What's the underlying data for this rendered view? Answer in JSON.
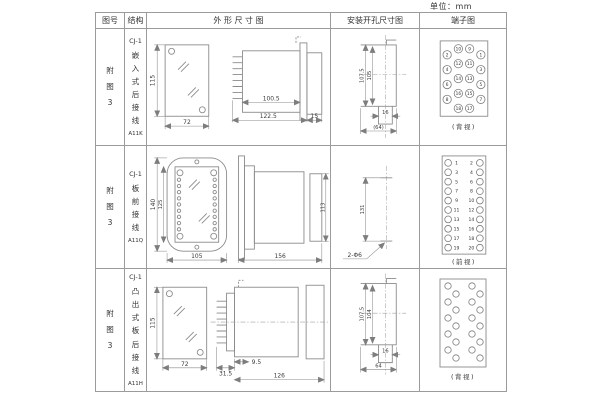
{
  "unit_label": "单位：mm",
  "table": {
    "columns": [
      "图号",
      "结构",
      "外 形 尺 寸 图",
      "安装开孔尺寸图",
      "端子图"
    ]
  },
  "rows": [
    {
      "figure_no": "附图3",
      "structure": {
        "model": "CJ-1",
        "desc": "嵌入式后接线",
        "code": "A11K"
      },
      "outline": {
        "front_height": "115",
        "front_width": "72",
        "body_length": "100.5",
        "total_length": "122.5",
        "rear_depth": "15"
      },
      "mounting": {
        "height_outer": "107.5",
        "height_inner": "105",
        "slot_width": "16",
        "cutout_width": "(64)"
      },
      "terminal": {
        "caption": "(背视)",
        "col_left": [
          "2",
          "4",
          "6",
          "8"
        ],
        "col_mid_left": [
          "10",
          "12",
          "14",
          "16",
          "18"
        ],
        "col_mid_right": [
          "9",
          "11",
          "13",
          "15",
          "17"
        ],
        "col_right": [
          "1",
          "3",
          "5",
          "7"
        ]
      }
    },
    {
      "figure_no": "附图3",
      "structure": {
        "model": "CJ-1",
        "desc": "板前接线",
        "code": "A11Q"
      },
      "outline": {
        "front_outer_height": "140",
        "front_inner_height": "125",
        "front_width": "105",
        "side_length": "156",
        "side_height": "113"
      },
      "mounting": {
        "hole_spacing": "131",
        "hole_label": "2-Φ6"
      },
      "terminal": {
        "caption": "(前视)",
        "col_left": [
          "1",
          "3",
          "5",
          "7",
          "9",
          "11",
          "13",
          "15",
          "17",
          "19"
        ],
        "col_right": [
          "2",
          "4",
          "6",
          "8",
          "10",
          "12",
          "14",
          "16",
          "18",
          "20"
        ]
      }
    },
    {
      "figure_no": "附图3",
      "structure": {
        "model": "CJ-1",
        "desc": "凸出式板后接线",
        "code": "A11H"
      },
      "outline": {
        "front_height": "115",
        "front_width": "72",
        "front_depth": "31.5",
        "step_depth": "9.5",
        "body_length": "126"
      },
      "mounting": {
        "height_outer": "107.5",
        "height_inner": "104",
        "slot_width": "16",
        "cutout_width": "64"
      },
      "terminal": {
        "caption": "(背视)"
      }
    }
  ]
}
